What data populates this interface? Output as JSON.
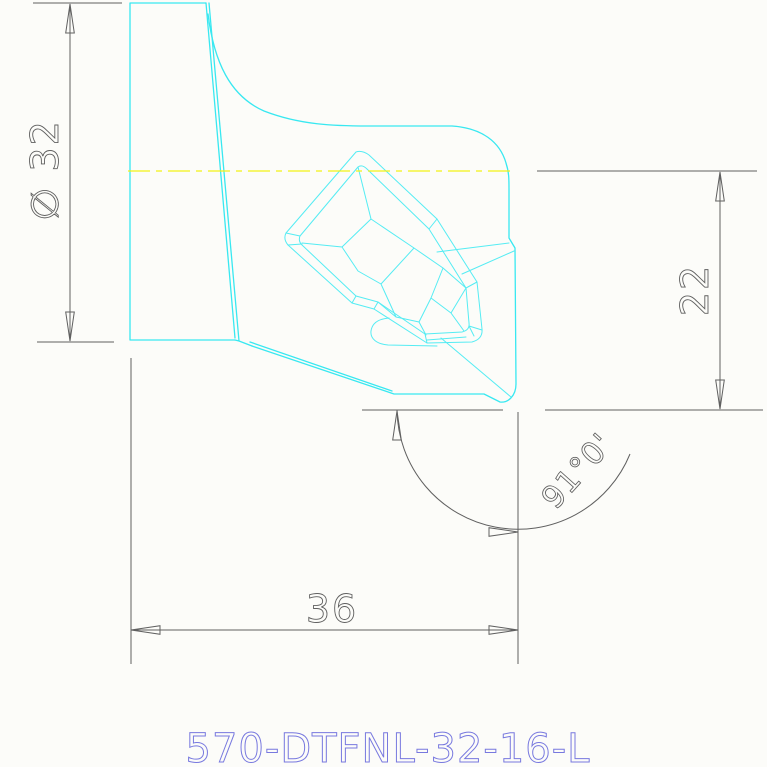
{
  "title": "570-DTFNL-32-16-L",
  "dims": {
    "diameter": "∅ 32",
    "height": "22",
    "length": "36",
    "angle": "91°0'"
  },
  "colors": {
    "background": "#FCFCF9",
    "part": "#38E8F1",
    "part-light": "#55ECF3",
    "centerline": "#F2F216",
    "dimension": "#606060",
    "title-text": "#7879DF"
  }
}
